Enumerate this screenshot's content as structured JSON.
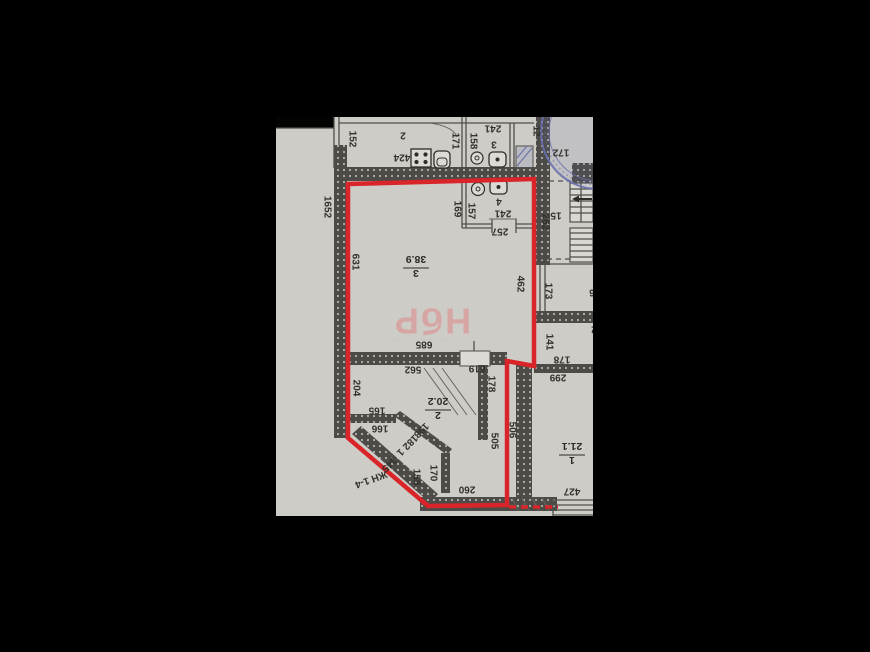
{
  "photo": {
    "background": "#000000",
    "paper_color": "#d5d4d0",
    "red_outline": "#e2242a",
    "stamp_blue": "#6b72b4",
    "watermark_pink": "#e59391",
    "ink": "#33312d"
  },
  "watermark": {
    "text": "НбР",
    "caption": "··························"
  },
  "room_labels": [
    {
      "number": "3",
      "area": "38.9",
      "x": 416,
      "y": 268
    },
    {
      "number": "2",
      "area": "20.2",
      "x": 438,
      "y": 410
    },
    {
      "number": "1",
      "area": "21.1",
      "x": 572,
      "y": 455
    }
  ],
  "dim_labels": [
    {
      "t": "152",
      "x": 352,
      "y": 139,
      "r": 90
    },
    {
      "t": "1652",
      "x": 327,
      "y": 207,
      "r": 90
    },
    {
      "t": "631",
      "x": 355,
      "y": 262,
      "r": 90
    },
    {
      "t": "171",
      "x": 455,
      "y": 141,
      "r": 90
    },
    {
      "t": "158",
      "x": 473,
      "y": 141,
      "r": 90
    },
    {
      "t": "12",
      "x": 536,
      "y": 131,
      "r": 90,
      "fs": 9
    },
    {
      "t": "169",
      "x": 457,
      "y": 209,
      "r": 90
    },
    {
      "t": "157",
      "x": 471,
      "y": 211,
      "r": 90
    },
    {
      "t": "462",
      "x": 520,
      "y": 284,
      "r": 90
    },
    {
      "t": "262",
      "x": 545,
      "y": 222,
      "r": 90
    },
    {
      "t": "173",
      "x": 548,
      "y": 291,
      "r": 90
    },
    {
      "t": "141",
      "x": 549,
      "y": 342,
      "r": 90
    },
    {
      "t": "204",
      "x": 356,
      "y": 388,
      "r": 90
    },
    {
      "t": "178",
      "x": 491,
      "y": 384,
      "r": 90
    },
    {
      "t": "505",
      "x": 494,
      "y": 441,
      "r": 90
    },
    {
      "t": "506",
      "x": 512,
      "y": 430,
      "r": 90
    },
    {
      "t": "158",
      "x": 416,
      "y": 477,
      "r": 90
    },
    {
      "t": "170",
      "x": 433,
      "y": 473,
      "r": 90
    },
    {
      "t": "2",
      "x": 403,
      "y": 135,
      "r": 180
    },
    {
      "t": "424",
      "x": 402,
      "y": 157,
      "r": 180
    },
    {
      "t": "241",
      "x": 493,
      "y": 128,
      "r": 180
    },
    {
      "t": "3",
      "x": 494,
      "y": 144,
      "r": 180
    },
    {
      "t": "172",
      "x": 561,
      "y": 152,
      "r": 180,
      "fs": 11
    },
    {
      "t": "4",
      "x": 499,
      "y": 201,
      "r": 180
    },
    {
      "t": "241",
      "x": 503,
      "y": 213,
      "r": 180
    },
    {
      "t": "257",
      "x": 500,
      "y": 231,
      "r": 180
    },
    {
      "t": "15",
      "x": 556,
      "y": 215,
      "r": 180
    },
    {
      "t": "685",
      "x": 424,
      "y": 344,
      "r": 180
    },
    {
      "t": "562",
      "x": 413,
      "y": 369,
      "r": 180
    },
    {
      "t": "619",
      "x": 477,
      "y": 368,
      "r": 180
    },
    {
      "t": "6",
      "x": 592,
      "y": 292,
      "r": 180
    },
    {
      "t": "2",
      "x": 594,
      "y": 329,
      "r": 180
    },
    {
      "t": "178",
      "x": 562,
      "y": 359,
      "r": 180
    },
    {
      "t": "299",
      "x": 558,
      "y": 377,
      "r": 180
    },
    {
      "t": "165",
      "x": 377,
      "y": 410,
      "r": 180
    },
    {
      "t": "166",
      "x": 380,
      "y": 428,
      "r": 180
    },
    {
      "t": "260",
      "x": 467,
      "y": 489,
      "r": 180
    },
    {
      "t": "427",
      "x": 572,
      "y": 491,
      "r": 180
    },
    {
      "t": "198",
      "x": 421,
      "y": 430,
      "r": 135,
      "fs": 9
    },
    {
      "t": "182",
      "x": 410,
      "y": 442,
      "r": 135,
      "fs": 9
    },
    {
      "t": "1",
      "x": 400,
      "y": 452,
      "r": 135,
      "fs": 9
    },
    {
      "t": "345",
      "x": 389,
      "y": 464,
      "r": 135,
      "fs": 9
    },
    {
      "t": "ЖН 1-4",
      "x": 371,
      "y": 479,
      "r": 160,
      "fs": 8
    }
  ]
}
